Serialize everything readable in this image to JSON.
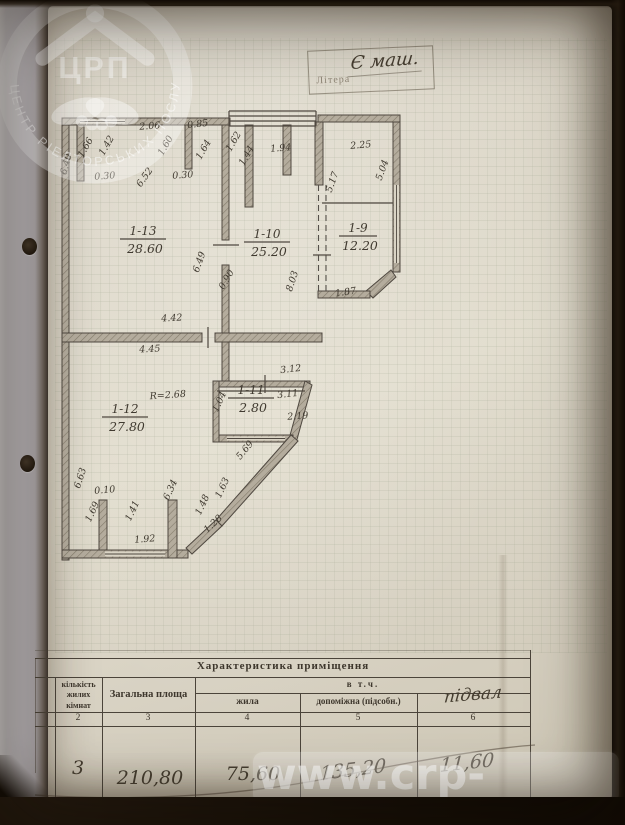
{
  "stamp": {
    "label": "Літера",
    "value": "Є маш."
  },
  "logo_watermark": {
    "abbr": "ЦРП",
    "ring_text": "ЦЕНТР РІЕЛТОРСЬКИХ ПОСЛУГ"
  },
  "site_watermark": "www.crp-m.com",
  "plan": {
    "rooms": [
      {
        "id": "1-13",
        "area": "28.60",
        "x": 88,
        "y": 130
      },
      {
        "id": "1-10",
        "area": "25.20",
        "x": 212,
        "y": 133
      },
      {
        "id": "1-9",
        "area": "12.20",
        "x": 303,
        "y": 127
      },
      {
        "id": "1-11",
        "area": "2.80",
        "x": 196,
        "y": 289
      },
      {
        "id": "1-12",
        "area": "27.80",
        "x": 70,
        "y": 308
      }
    ],
    "dimensions": [
      {
        "t": "2.06",
        "x": 95,
        "y": 24,
        "r": -4
      },
      {
        "t": "0.85",
        "x": 143,
        "y": 22,
        "r": -6
      },
      {
        "t": "1.94",
        "x": 226,
        "y": 46,
        "r": -5
      },
      {
        "t": "2.25",
        "x": 306,
        "y": 43,
        "r": -5
      },
      {
        "t": "1.66",
        "x": 33,
        "y": 44,
        "r": -60
      },
      {
        "t": "1.42",
        "x": 54,
        "y": 42,
        "r": -60
      },
      {
        "t": "1.60",
        "x": 113,
        "y": 42,
        "r": -60
      },
      {
        "t": "1.64",
        "x": 151,
        "y": 46,
        "r": -60
      },
      {
        "t": "1.62",
        "x": 181,
        "y": 38,
        "r": -60
      },
      {
        "t": "1.44",
        "x": 194,
        "y": 52,
        "r": -60
      },
      {
        "t": "6.40",
        "x": 14,
        "y": 60,
        "r": -75
      },
      {
        "t": "0.30",
        "x": 50,
        "y": 74,
        "r": -4
      },
      {
        "t": "6.52",
        "x": 92,
        "y": 74,
        "r": -55
      },
      {
        "t": "0.30",
        "x": 128,
        "y": 73,
        "r": -4
      },
      {
        "t": "5.17",
        "x": 280,
        "y": 78,
        "r": -70
      },
      {
        "t": "5.04",
        "x": 330,
        "y": 66,
        "r": -70
      },
      {
        "t": "6.49",
        "x": 147,
        "y": 158,
        "r": -70
      },
      {
        "t": "0.90",
        "x": 174,
        "y": 176,
        "r": -60
      },
      {
        "t": "8.03",
        "x": 240,
        "y": 177,
        "r": -72
      },
      {
        "t": "1.87",
        "x": 291,
        "y": 190,
        "r": -8
      },
      {
        "t": "4.42",
        "x": 117,
        "y": 216,
        "r": -3
      },
      {
        "t": "4.45",
        "x": 95,
        "y": 247,
        "r": -3
      },
      {
        "t": "R=2.68",
        "x": 113,
        "y": 293,
        "r": -4
      },
      {
        "t": "3.12",
        "x": 236,
        "y": 267,
        "r": -6
      },
      {
        "t": "3.11",
        "x": 233,
        "y": 292,
        "r": -6
      },
      {
        "t": "2.19",
        "x": 243,
        "y": 314,
        "r": -4
      },
      {
        "t": "1.04",
        "x": 167,
        "y": 298,
        "r": -65
      },
      {
        "t": "5.69",
        "x": 192,
        "y": 347,
        "r": -50
      },
      {
        "t": "6.63",
        "x": 28,
        "y": 374,
        "r": -72
      },
      {
        "t": "0.10",
        "x": 50,
        "y": 388,
        "r": -5
      },
      {
        "t": "1.69",
        "x": 40,
        "y": 408,
        "r": -65
      },
      {
        "t": "1.41",
        "x": 80,
        "y": 407,
        "r": -65
      },
      {
        "t": "6.34",
        "x": 118,
        "y": 386,
        "r": -65
      },
      {
        "t": "1.48",
        "x": 150,
        "y": 401,
        "r": -65
      },
      {
        "t": "1.63",
        "x": 170,
        "y": 384,
        "r": -65
      },
      {
        "t": "1.28",
        "x": 160,
        "y": 421,
        "r": -43
      },
      {
        "t": "1.92",
        "x": 90,
        "y": 437,
        "r": -4
      }
    ]
  },
  "table": {
    "title": "Характеристика приміщення",
    "subheader": "в т.ч.",
    "columns": [
      {
        "label": "кількість жилих кімнат",
        "num": "2",
        "value": "3"
      },
      {
        "label": "Загальна площа",
        "num": "3",
        "value": "210,80"
      },
      {
        "label": "жила",
        "num": "4",
        "value": "75,60"
      },
      {
        "label": "допоміжна (підсобн.)",
        "num": "5",
        "value": "135,20"
      },
      {
        "label": "підвал",
        "num": "6",
        "value": "11,60"
      }
    ]
  },
  "colors": {
    "paper": "#dcd6c8",
    "ink": "#403a30",
    "wall_fill": "#b4ac9d",
    "table_line": "#4b443a",
    "watermark": "#ffffff"
  }
}
